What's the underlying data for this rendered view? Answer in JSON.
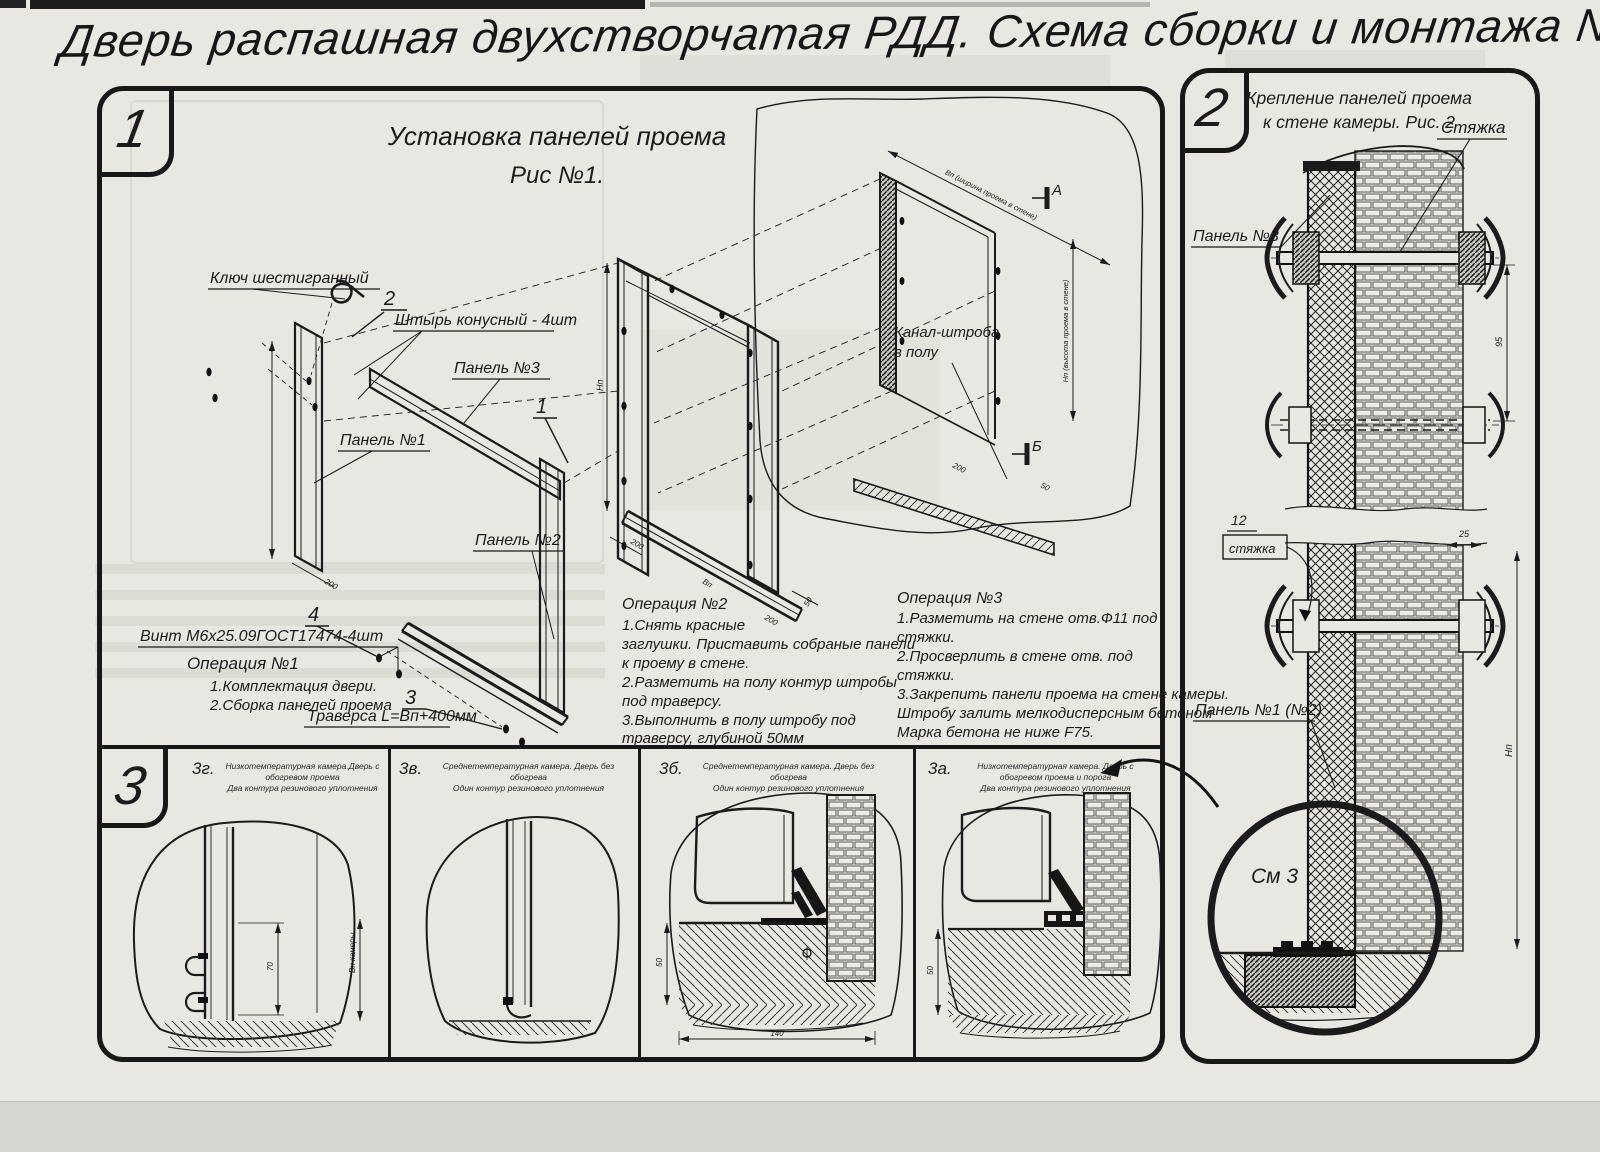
{
  "title": "Дверь распашная двухстворчатая РДД.  Схема сборки и монтажа №2",
  "section1": {
    "tab": "1",
    "heading1": "Установка панелей проема",
    "heading2": "Рис №1.",
    "labels": {
      "hex_key": "Ключ шестигранный",
      "pin": "Штырь конусный - 4шт",
      "panel3": "Панель №3",
      "panel1": "Панель №1",
      "panel2": "Панель №2",
      "screw": "Винт М6х25.09ГОСТ17474-4шт",
      "traverse": "Траверса  L=Вп+400мм",
      "channel1": "Канал-штроба",
      "channel2": "в полу",
      "b1": "1",
      "b2": "2",
      "b3": "3",
      "b4": "4",
      "marker_a": "А",
      "marker_b": "Б",
      "dim_w": "Вп (ширина проема в стене)",
      "dim_h": "Нп (высота проема в стене)"
    },
    "dims": {
      "np": "Нп",
      "d200a": "200",
      "bp": "Вп",
      "d200b": "200",
      "d50": "50",
      "d200c": "200",
      "d200d": "200",
      "d50b": "50"
    },
    "op1": {
      "title": "Операция №1",
      "l1": "1.Комплектация двери.",
      "l2": "2.Сборка панелей проема"
    },
    "op2": {
      "title": "Операция №2",
      "l1": "1.Снять красные",
      "l2": "заглушки. Приставить собраные панели",
      "l3": "к проему в стене.",
      "l4": "2.Разметить на полу контур штробы",
      "l5": "под траверсу.",
      "l6": "3.Выполнить в полу штробу под",
      "l7": "траверсу, глубиной 50мм"
    },
    "op3": {
      "title": "Операция №3",
      "l1": "1.Разметить на стене отв.Ф11 под",
      "l2": "стяжки.",
      "l3": "2.Просверлить в стене отв.  под",
      "l4": "стяжки.",
      "l5": "3.Закрепить панели проема на стене камеры.",
      "l6": "Штробу залить мелкодисперсным бетоном",
      "l7": "Марка бетона не ниже  F75."
    }
  },
  "section2": {
    "tab": "2",
    "heading1": "Крепление панелей проема",
    "heading2": "к стене камеры. Рис. 2",
    "labels": {
      "tie": "Стяжка",
      "panel3": "Панель №3",
      "pos": "12",
      "pos_name": "стяжка",
      "panel12": "Панель №1 (№2)",
      "see": "См 3",
      "dim95": "95",
      "dim25": "25",
      "dimh": "Нп"
    }
  },
  "section3": {
    "tab": "3",
    "panels": [
      {
        "label": "3г.",
        "cap1": "Низкотемпературная камера.Дверь с обогревом проема",
        "cap2": "Два контура резинового уплотнения",
        "d1": "70",
        "d2": "Вн камеры"
      },
      {
        "label": "3в.",
        "cap1": "Среднетемпературная камера. Дверь без обогрева",
        "cap2": "Один контур резинового уплотнения"
      },
      {
        "label": "3б.",
        "cap1": "Среднетемпературная камера. Дверь без обогрева",
        "cap2": "Один контур резинового уплотнения",
        "d1": "50",
        "d2": "140"
      },
      {
        "label": "3а.",
        "cap1": "Низкотемпературная камера. Дверь с обогревом проема и порога",
        "cap2": "Два контура резинового уплотнения",
        "d1": "50"
      }
    ]
  }
}
